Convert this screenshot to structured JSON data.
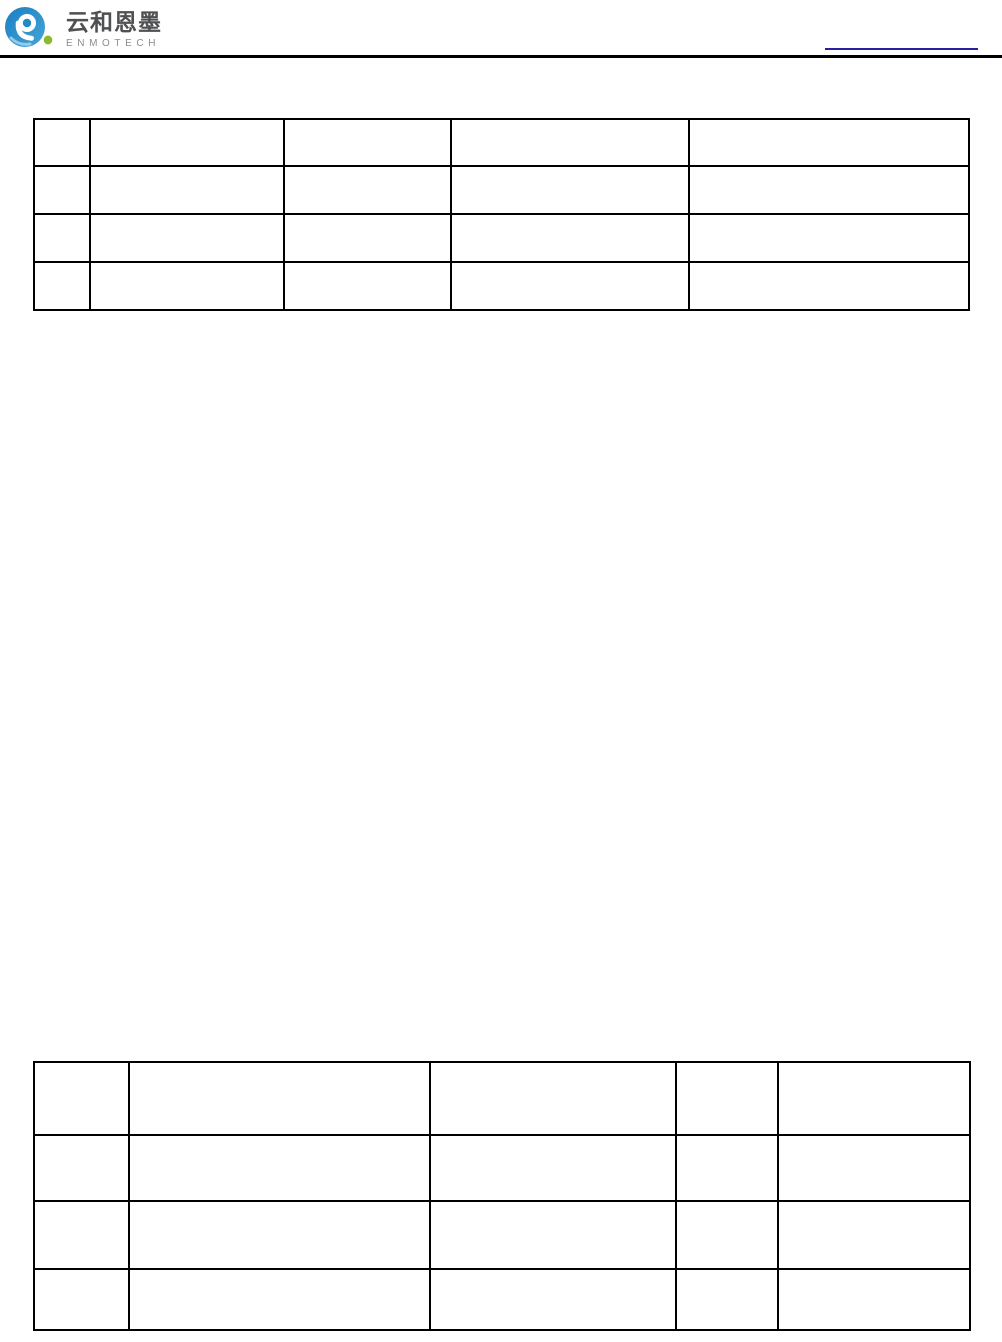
{
  "page": {
    "background_color": "#ffffff"
  },
  "header": {
    "logo": {
      "name_cn": "云和恩墨",
      "name_en": "ENMOTECH",
      "icon": "enmotech-swirl-logo",
      "colors": {
        "swirl_blue": "#1e83c4",
        "swirl_light_blue": "#9fd0e8",
        "dot_green": "#8db92c",
        "text_cn": "#4f5052",
        "text_en": "#8a8c8f"
      }
    },
    "rule_color": "#000000",
    "blank_link_underline_color": "#261fa2"
  },
  "tables": [
    {
      "name": "top-table",
      "column_count": 5,
      "rows": [
        [
          "",
          "",
          "",
          "",
          ""
        ],
        [
          "",
          "",
          "",
          "",
          ""
        ],
        [
          "",
          "",
          "",
          "",
          ""
        ],
        [
          "",
          "",
          "",
          "",
          ""
        ]
      ]
    },
    {
      "name": "bottom-table",
      "column_count": 5,
      "rows": [
        [
          "",
          "",
          "",
          "",
          ""
        ],
        [
          "",
          "",
          "",
          "",
          ""
        ],
        [
          "",
          "",
          "",
          "",
          ""
        ],
        [
          "",
          "",
          "",
          "",
          ""
        ]
      ]
    }
  ]
}
